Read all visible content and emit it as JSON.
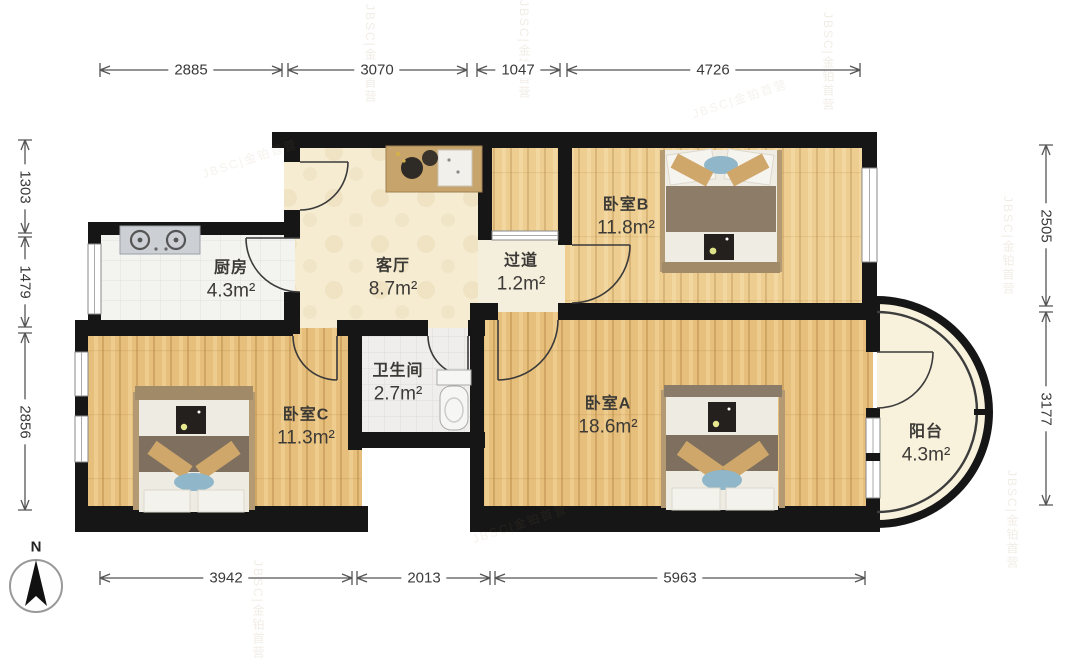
{
  "compass": {
    "label": "N"
  },
  "watermark": {
    "text": "JBSC|金铂首营"
  },
  "rooms": [
    {
      "id": "kitchen",
      "name": "厨房",
      "area": "4.3m²"
    },
    {
      "id": "living",
      "name": "客厅",
      "area": "8.7m²"
    },
    {
      "id": "hallway",
      "name": "过道",
      "area": "1.2m²"
    },
    {
      "id": "bedroomB",
      "name": "卧室B",
      "area": "11.8m²"
    },
    {
      "id": "bedroomC",
      "name": "卧室C",
      "area": "11.3m²"
    },
    {
      "id": "bathroom",
      "name": "卫生间",
      "area": "2.7m²"
    },
    {
      "id": "bedroomA",
      "name": "卧室A",
      "area": "18.6m²"
    },
    {
      "id": "balcony",
      "name": "阳台",
      "area": "4.3m²"
    }
  ],
  "dimensions": {
    "top": [
      "2885",
      "3070",
      "1047",
      "4726"
    ],
    "bottom": [
      "3942",
      "2013",
      "5963"
    ],
    "left": [
      "1303",
      "1479",
      "2856"
    ],
    "right": [
      "2505",
      "3177"
    ]
  }
}
